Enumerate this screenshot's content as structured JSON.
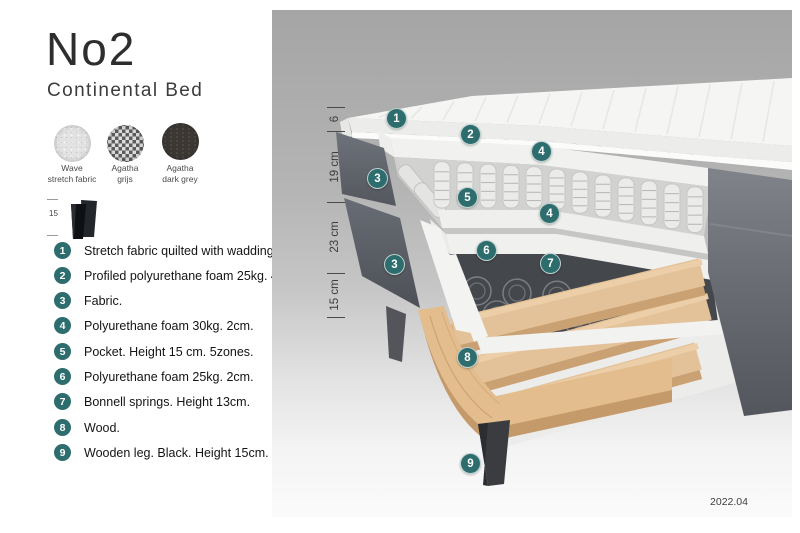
{
  "product": {
    "title": "No2",
    "subtitle": "Continental Bed"
  },
  "swatches": [
    {
      "name_line1": "Wave",
      "name_line2": "stretch fabric"
    },
    {
      "name_line1": "Agatha",
      "name_line2": "grijs"
    },
    {
      "name_line1": "Agatha",
      "name_line2": "dark grey"
    }
  ],
  "leg_thumb": {
    "dimension": "15"
  },
  "legend": {
    "items": [
      {
        "num": "1",
        "text": "Stretch fabric quilted with wadding."
      },
      {
        "num": "2",
        "text": "Profiled polyurethane foam 25kg. 4cm."
      },
      {
        "num": "3",
        "text": "Fabric."
      },
      {
        "num": "4",
        "text": "Polyurethane foam 30kg. 2cm."
      },
      {
        "num": "5",
        "text": "Pocket. Height 15 cm. 5zones."
      },
      {
        "num": "6",
        "text": "Polyurethane foam 25kg. 2cm."
      },
      {
        "num": "7",
        "text": "Bonnell springs. Height 13cm."
      },
      {
        "num": "8",
        "text": "Wood."
      },
      {
        "num": "9",
        "text": "Wooden leg. Black. Height 15cm."
      }
    ]
  },
  "diagram": {
    "dimensions": [
      {
        "label": "6"
      },
      {
        "label": "19 cm"
      },
      {
        "label": "23 cm"
      },
      {
        "label": "15 cm"
      }
    ],
    "markers": [
      {
        "label": "1"
      },
      {
        "label": "2"
      },
      {
        "label": "4"
      },
      {
        "label": "3"
      },
      {
        "label": "5"
      },
      {
        "label": "4"
      },
      {
        "label": "6"
      },
      {
        "label": "3"
      },
      {
        "label": "7"
      },
      {
        "label": "8"
      },
      {
        "label": "9"
      }
    ],
    "caption": "2022.04"
  },
  "colors": {
    "accent_teal": "#2E6D6D",
    "wood": "#E3BD8E",
    "fabric_dark_grey": "#63666D",
    "leg_black": "#3A3C3F"
  }
}
